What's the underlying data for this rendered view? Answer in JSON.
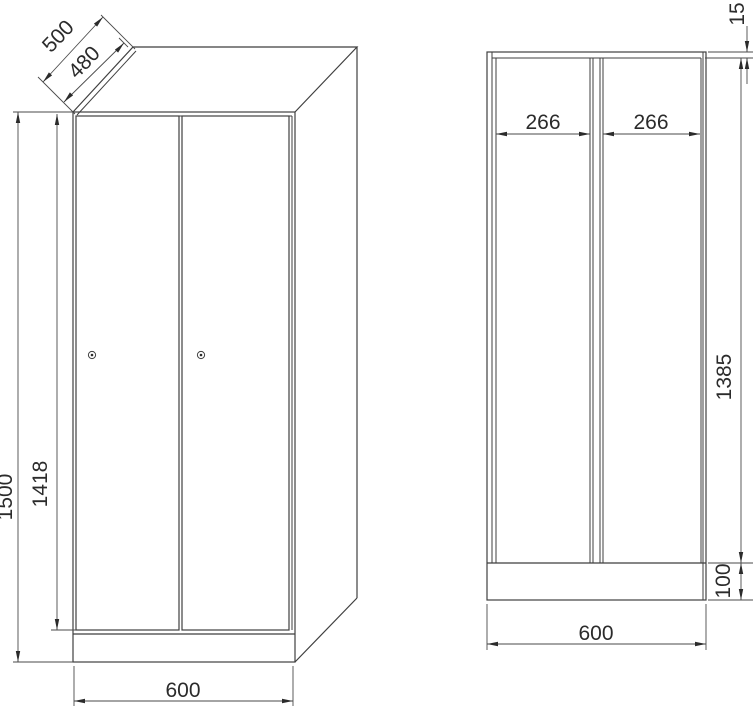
{
  "front": {
    "depth": "500",
    "depth_inner": "480",
    "total_height": "1500",
    "door_height": "1418",
    "width": "600"
  },
  "section": {
    "left_compartment": "266",
    "right_compartment": "266",
    "top_panel": "15",
    "inner_height": "1385",
    "plinth": "100",
    "width": "600"
  },
  "colors": {
    "line": "#3f3f3f",
    "text": "#2b2b2b",
    "background": "#ffffff"
  }
}
